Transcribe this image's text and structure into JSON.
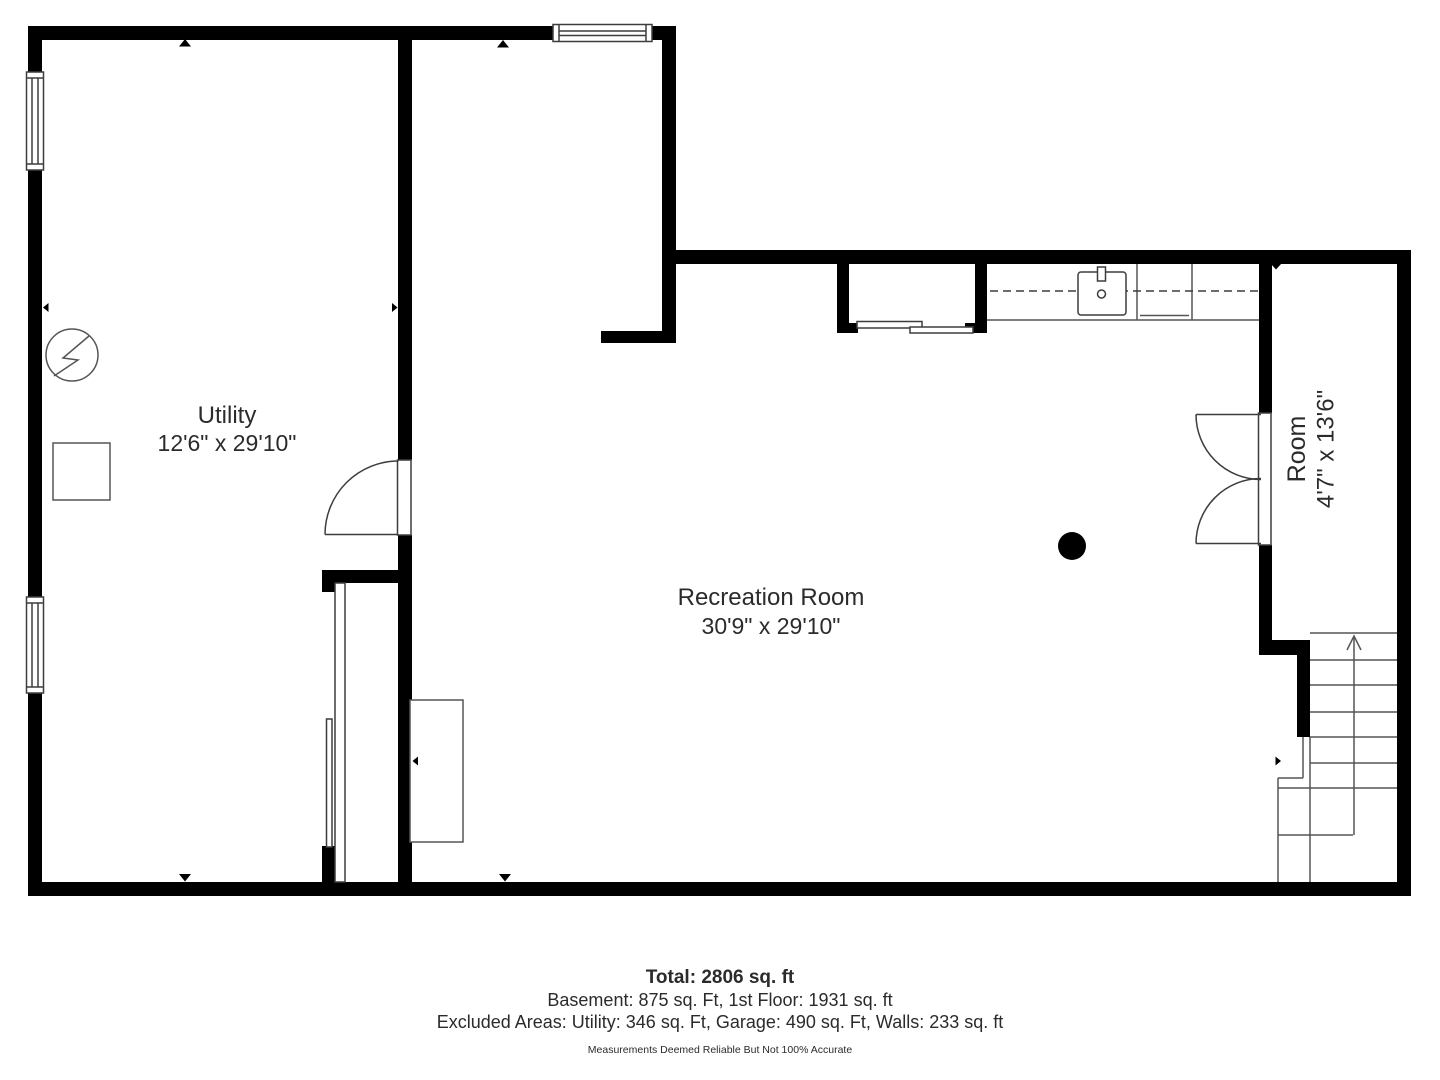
{
  "floorplan": {
    "rooms": {
      "utility": {
        "name": "Utility",
        "dimensions": "12'6\" x 29'10\""
      },
      "recreation": {
        "name": "Recreation Room",
        "dimensions": "30'9\" x 29'10\""
      },
      "side_room": {
        "name": "Room",
        "dimensions": "4'7\" x 13'6\""
      }
    },
    "symbols": {
      "electrical_panel": "circle-lightning-icon",
      "support_column": "filled-dot",
      "stairs_direction": "up-arrow"
    },
    "footer": {
      "total": "Total: 2806 sq. ft",
      "floors": "Basement: 875 sq. Ft, 1st Floor: 1931 sq. ft",
      "excluded": "Excluded Areas: Utility: 346 sq. Ft, Garage: 490 sq. Ft, Walls: 233 sq. ft",
      "disclaimer": "Measurements Deemed Reliable But Not 100% Accurate"
    },
    "colors": {
      "wall": "#000000",
      "line": "#3d3d3d",
      "text": "#2b2b2b",
      "background": "#ffffff"
    }
  }
}
